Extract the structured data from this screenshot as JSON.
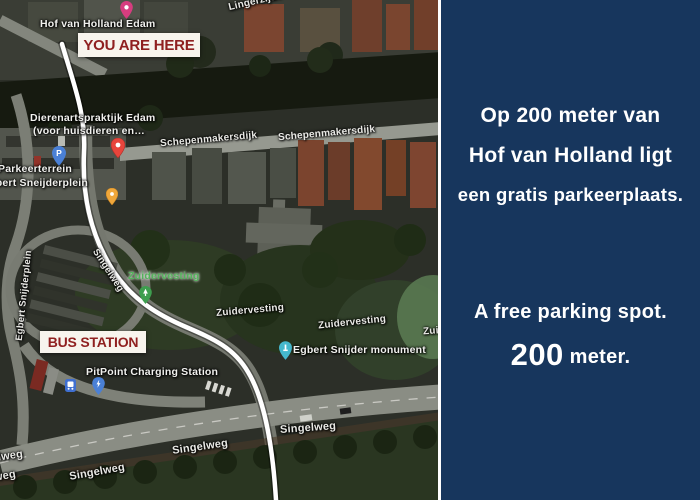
{
  "map": {
    "banners": {
      "you_are_here": "YOU ARE HERE",
      "bus_station": "BUS STATION"
    },
    "pois": {
      "hotel": {
        "label": "Hof van Holland Edam",
        "icon": "hotel-pin"
      },
      "vet": {
        "line1": "Dierenartspraktijk Edam",
        "line2": "(voor huisdieren en…",
        "icon": "red-pin"
      },
      "parking": {
        "line1": "Parkeerterrein",
        "line2": "Egbert Sneijderplein",
        "icon": "parking-pin"
      },
      "park": {
        "label": "Zuidervesting",
        "icon": "tree-pin"
      },
      "monument": {
        "label": "Egbert Snijder monument",
        "icon": "monument-pin"
      },
      "charging": {
        "label": "PitPoint Charging Station",
        "icon": "charging-pin"
      }
    },
    "streets": {
      "lingerzijde": "Lingerzijde",
      "schepenmakersdijk_1": "Schepenmakersdijk",
      "schepenmakersdijk_2": "Schepenmakersdijk",
      "egbert_snijderplein_vertical": "Egbert Snijderplein",
      "singelweg_route": "Singelweg",
      "zuidervesting_1": "Zuidervesting",
      "zuidervesting_2": "Zuidervesting",
      "zuidervesting_3_partial": "Zuidervesting",
      "singelweg_1": "Singelweg",
      "singelweg_2": "Singelweg",
      "singelweg_3": "Singelweg",
      "singelweg_4_partial": "Singelweg",
      "singelweg_5_partial": "Singelweg"
    }
  },
  "panel": {
    "dutch_line1": "Op 200 meter van",
    "dutch_line2": "Hof van Holland ligt",
    "dutch_line3": "een gratis parkeerplaats.",
    "english_line1": "A free parking spot.",
    "english_distance_number": "200",
    "english_distance_unit": " meter."
  },
  "colors": {
    "panel_navy": "#17365d",
    "banner_background": "#f7f4ed",
    "banner_red": "#8f2020",
    "route_line": "#ffffff",
    "hotel_pin": "#d63d7f",
    "red_pin": "#e8453c",
    "orange_pin": "#f0a73b",
    "parking_pin": "#4a80d6",
    "tree_pin": "#3e9e4f",
    "monument_pin": "#45b8cd",
    "park_label_green": "#54b35c"
  }
}
